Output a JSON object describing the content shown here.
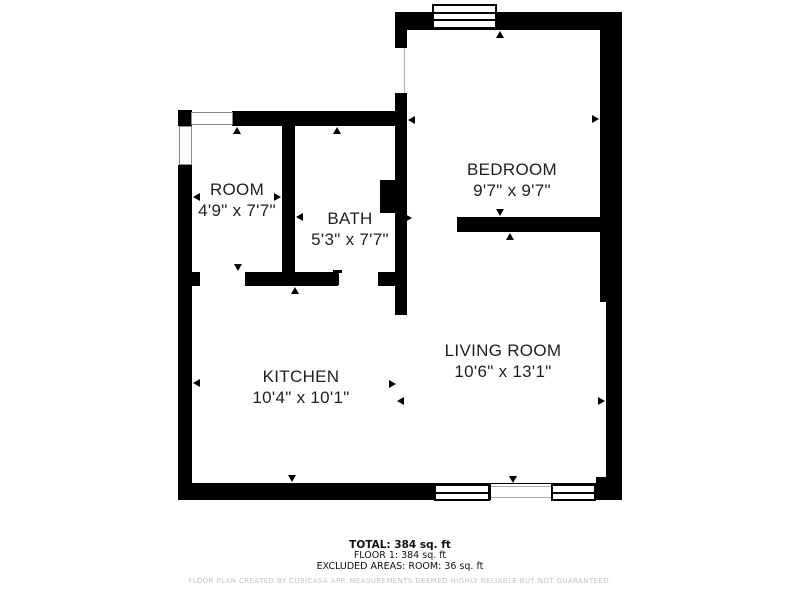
{
  "title": "Floor plan",
  "colors": {
    "wall": "#000000",
    "label": "#1f1f1f",
    "thin_line": "#b0b0b0",
    "light_frame": "#8a8a8a",
    "muted": "#c4c4c4",
    "bg": "#ffffff"
  },
  "rooms": [
    {
      "name": "BEDROOM",
      "dims": "9'7\" x 9'7\"",
      "cx": 512,
      "cy": 181
    },
    {
      "name": "ROOM",
      "dims": "4'9\" x 7'7\"",
      "cx": 237,
      "cy": 201
    },
    {
      "name": "BATH",
      "dims": "5'3\" x 7'7\"",
      "cx": 350,
      "cy": 230
    },
    {
      "name": "KITCHEN",
      "dims": "10'4\" x 10'1\"",
      "cx": 301,
      "cy": 388
    },
    {
      "name": "LIVING ROOM",
      "dims": "10'6\" x 13'1\"",
      "cx": 503,
      "cy": 362
    }
  ],
  "geometry": {
    "walls": [
      {
        "x": 395,
        "y": 12,
        "w": 227,
        "h": 18
      },
      {
        "x": 600,
        "y": 12,
        "w": 22,
        "h": 290
      },
      {
        "x": 606,
        "y": 302,
        "w": 16,
        "h": 198
      },
      {
        "x": 596,
        "y": 477,
        "w": 26,
        "h": 8
      },
      {
        "x": 178,
        "y": 483,
        "w": 444,
        "h": 17
      },
      {
        "x": 178,
        "y": 165,
        "w": 14,
        "h": 318
      },
      {
        "x": 178,
        "y": 110,
        "w": 14,
        "h": 16
      },
      {
        "x": 232,
        "y": 111,
        "w": 175,
        "h": 15
      },
      {
        "x": 395,
        "y": 12,
        "w": 12,
        "h": 36
      },
      {
        "x": 395,
        "y": 93,
        "w": 12,
        "h": 222
      },
      {
        "x": 380,
        "y": 180,
        "w": 15,
        "h": 33
      },
      {
        "x": 282,
        "y": 111,
        "w": 13,
        "h": 175
      },
      {
        "x": 178,
        "y": 272,
        "w": 22,
        "h": 14
      },
      {
        "x": 245,
        "y": 272,
        "w": 93,
        "h": 14
      },
      {
        "x": 378,
        "y": 272,
        "w": 17,
        "h": 14
      },
      {
        "x": 457,
        "y": 217,
        "w": 143,
        "h": 15
      },
      {
        "x": 333,
        "y": 270,
        "w": 9,
        "h": 3
      },
      {
        "x": 336,
        "y": 273,
        "w": 3,
        "h": 12
      }
    ],
    "voids": [
      {
        "x": 491,
        "y": 484,
        "w": 60,
        "h": 16
      }
    ],
    "windows": [
      {
        "x": 432,
        "y": 4,
        "w": 65,
        "h": 25,
        "lines": 2,
        "frame": "dark"
      },
      {
        "x": 191,
        "y": 112,
        "w": 42,
        "h": 13,
        "lines": 0,
        "frame": "light"
      },
      {
        "x": 179,
        "y": 126,
        "w": 13,
        "h": 39,
        "lines": 0,
        "frame": "light"
      },
      {
        "x": 434,
        "y": 484,
        "w": 56,
        "h": 17,
        "lines": 1,
        "frame": "dark"
      },
      {
        "x": 551,
        "y": 484,
        "w": 45,
        "h": 17,
        "lines": 1,
        "frame": "dark"
      }
    ],
    "thin_lines": [
      {
        "x": 404,
        "y": 48,
        "w": 1,
        "h": 45
      },
      {
        "x": 491,
        "y": 486,
        "w": 60,
        "h": 1
      },
      {
        "x": 491,
        "y": 497,
        "w": 60,
        "h": 1
      }
    ],
    "arrows": [
      {
        "x": 500,
        "y": 31,
        "d": "up"
      },
      {
        "x": 237,
        "y": 127,
        "d": "up"
      },
      {
        "x": 337,
        "y": 127,
        "d": "up"
      },
      {
        "x": 295,
        "y": 287,
        "d": "up"
      },
      {
        "x": 510,
        "y": 233,
        "d": "up"
      },
      {
        "x": 238,
        "y": 271,
        "d": "down"
      },
      {
        "x": 500,
        "y": 216,
        "d": "down"
      },
      {
        "x": 292,
        "y": 482,
        "d": "down"
      },
      {
        "x": 513,
        "y": 483,
        "d": "down"
      },
      {
        "x": 193,
        "y": 197,
        "d": "left"
      },
      {
        "x": 296,
        "y": 217,
        "d": "left"
      },
      {
        "x": 193,
        "y": 383,
        "d": "left"
      },
      {
        "x": 397,
        "y": 401,
        "d": "left"
      },
      {
        "x": 408,
        "y": 120,
        "d": "left"
      },
      {
        "x": 281,
        "y": 197,
        "d": "right"
      },
      {
        "x": 599,
        "y": 119,
        "d": "right"
      },
      {
        "x": 396,
        "y": 384,
        "d": "right"
      },
      {
        "x": 605,
        "y": 401,
        "d": "right"
      },
      {
        "x": 412,
        "y": 218,
        "d": "right"
      }
    ]
  },
  "footer": {
    "total": "TOTAL: 384 sq. ft",
    "floor": "FLOOR 1: 384 sq. ft",
    "excluded": "EXCLUDED AREAS: ROOM: 36 sq. ft",
    "disclaimer": "FLOOR PLAN CREATED BY CUBICASA APP. MEASUREMENTS DEEMED HIGHLY RELIABLE BUT NOT GUARANTEED."
  }
}
